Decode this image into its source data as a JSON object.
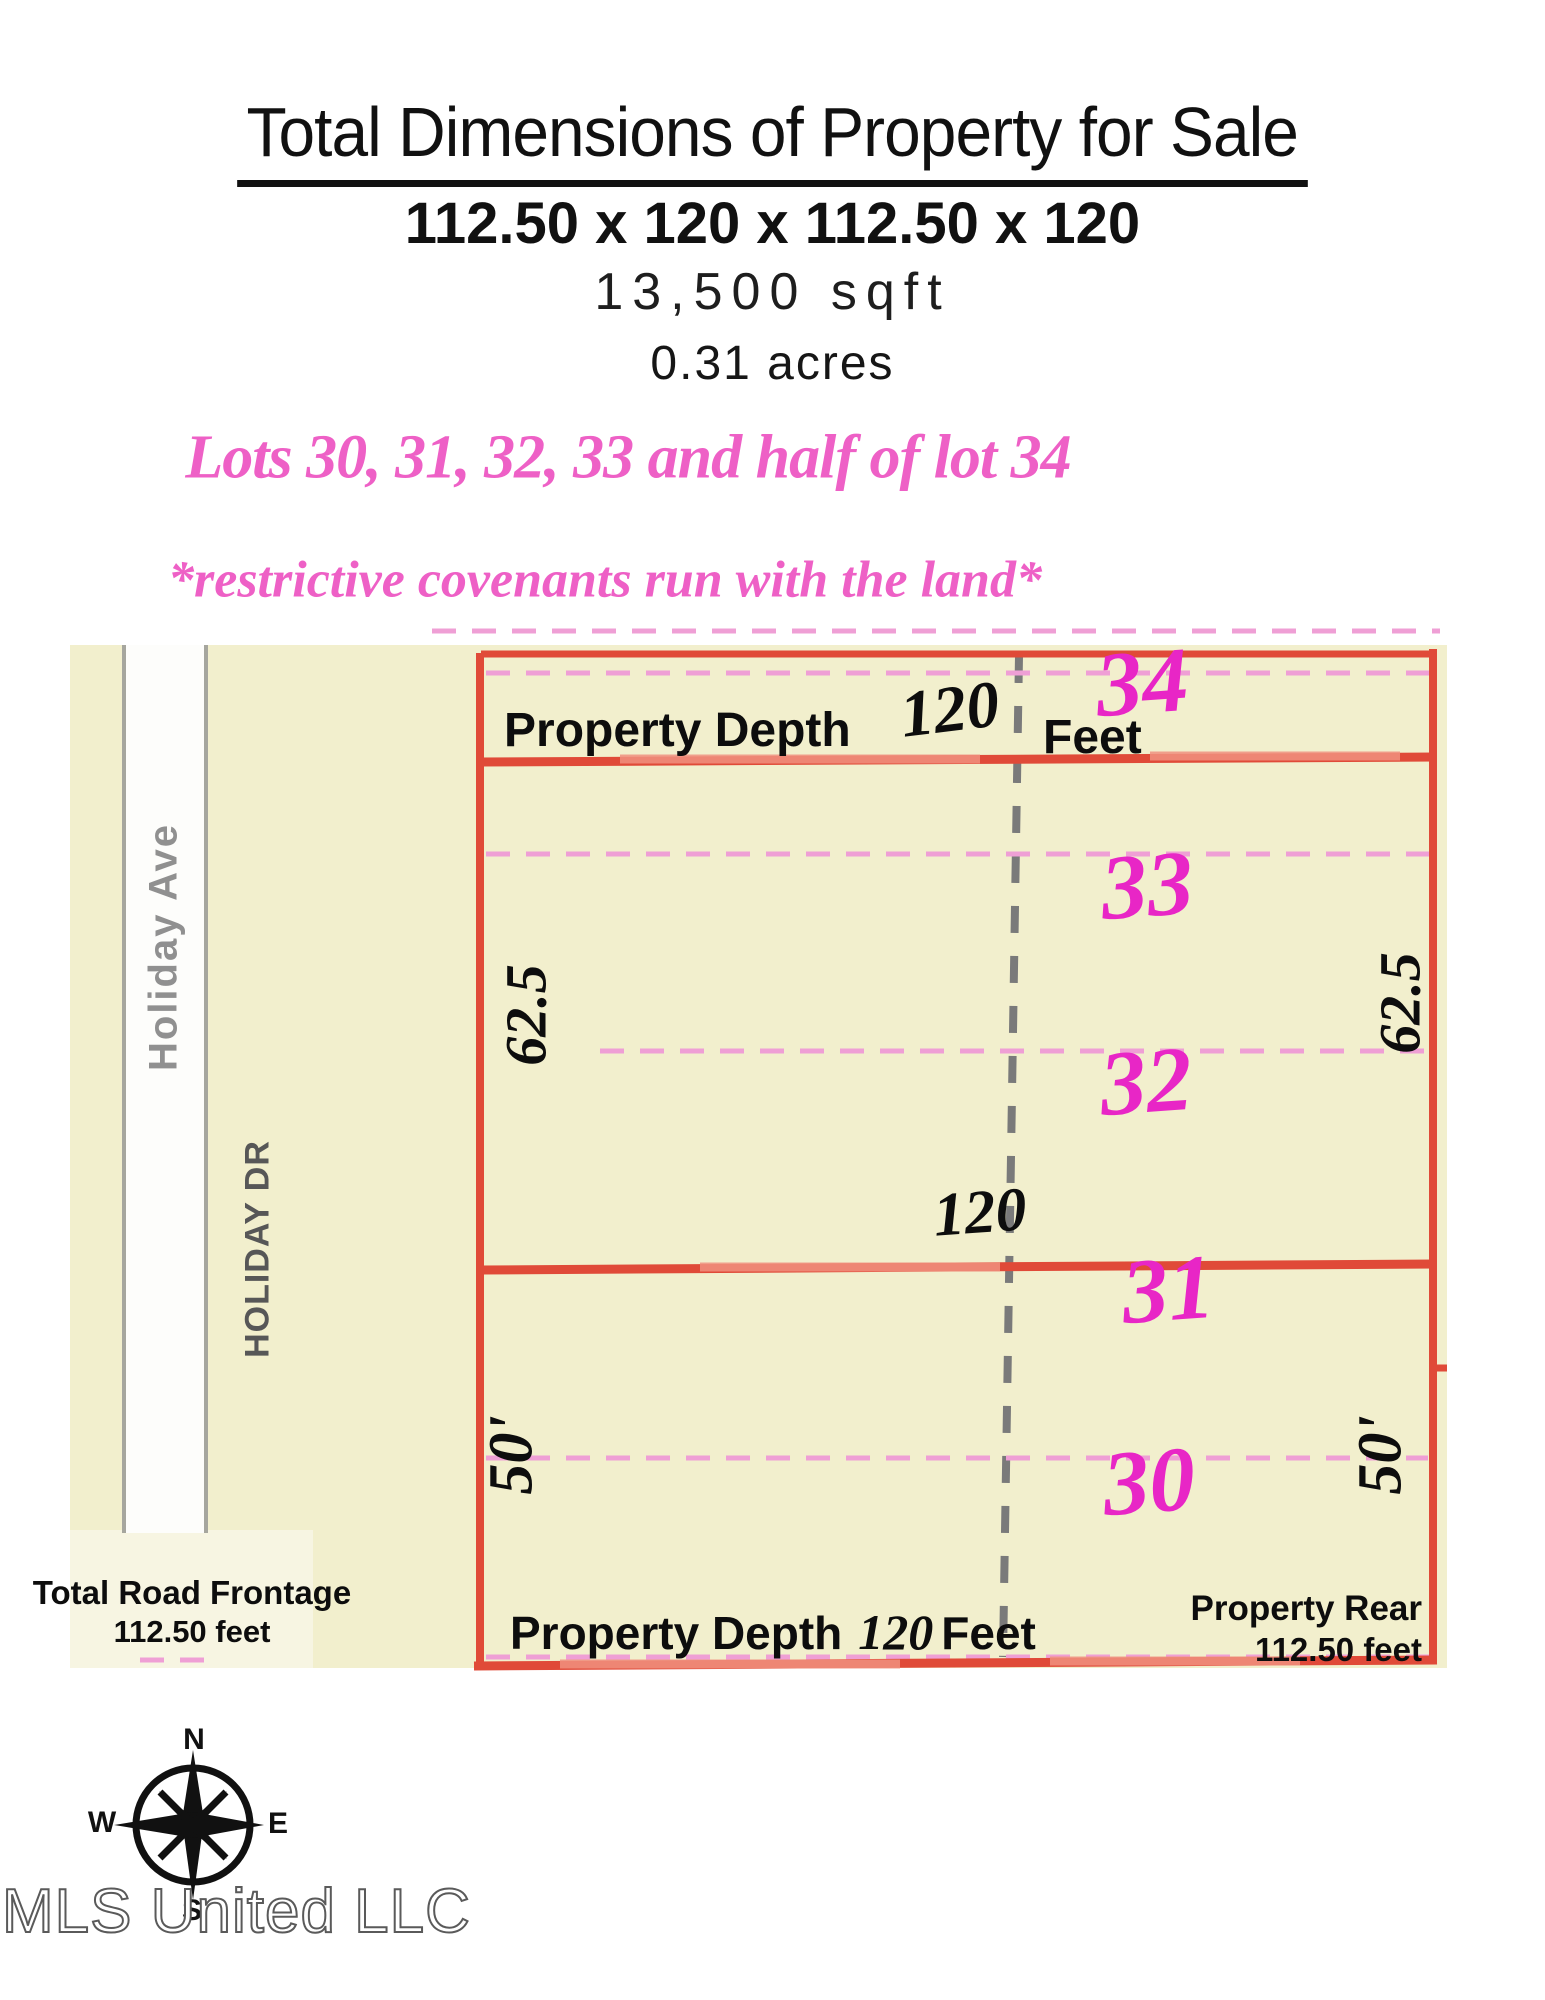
{
  "header": {
    "title": "Total Dimensions of Property for Sale",
    "dimensions": "112.50 x 120 x 112.50 x 120",
    "sqft": "13,500 sqft",
    "acres": "0.31 acres",
    "lots_line": "Lots 30, 31, 32, 33 and half of lot 34",
    "covenants_line": "*restrictive covenants run with the land*"
  },
  "diagram": {
    "streets": {
      "avenue": "Holiday Ave",
      "drive": "HOLIDAY DR"
    },
    "labels": {
      "property_depth_top": "Property Depth",
      "depth_value_top": "120",
      "feet_top": "Feet",
      "property_depth_bottom": "Property Depth",
      "depth_value_bottom": "120",
      "feet_bottom": "Feet",
      "depth_value_mid": "120",
      "side_62_left": "62.5",
      "side_62_right": "62.5",
      "side_50_left": "50'",
      "side_50_right": "50'",
      "road_frontage_line1": "Total Road Frontage",
      "road_frontage_line2": "112.50 feet",
      "property_rear_line1": "Property Rear",
      "property_rear_line2": "112.50 feet"
    },
    "lots": [
      {
        "number": "34"
      },
      {
        "number": "33"
      },
      {
        "number": "32"
      },
      {
        "number": "31"
      },
      {
        "number": "30"
      }
    ],
    "colors": {
      "cream": "#f2efcd",
      "cream_light": "#f7f5e2",
      "boundary_red": "#e04a38",
      "pink_dash": "#ef9fd5",
      "lot_number_magenta": "#e826c6",
      "header_pink": "#ee60c6",
      "survey_dash_gray": "#7a7a7a"
    }
  },
  "footer": {
    "compass": {
      "north": "N",
      "south": "S",
      "east": "E",
      "west": "W"
    },
    "watermark": "MLS United LLC"
  }
}
